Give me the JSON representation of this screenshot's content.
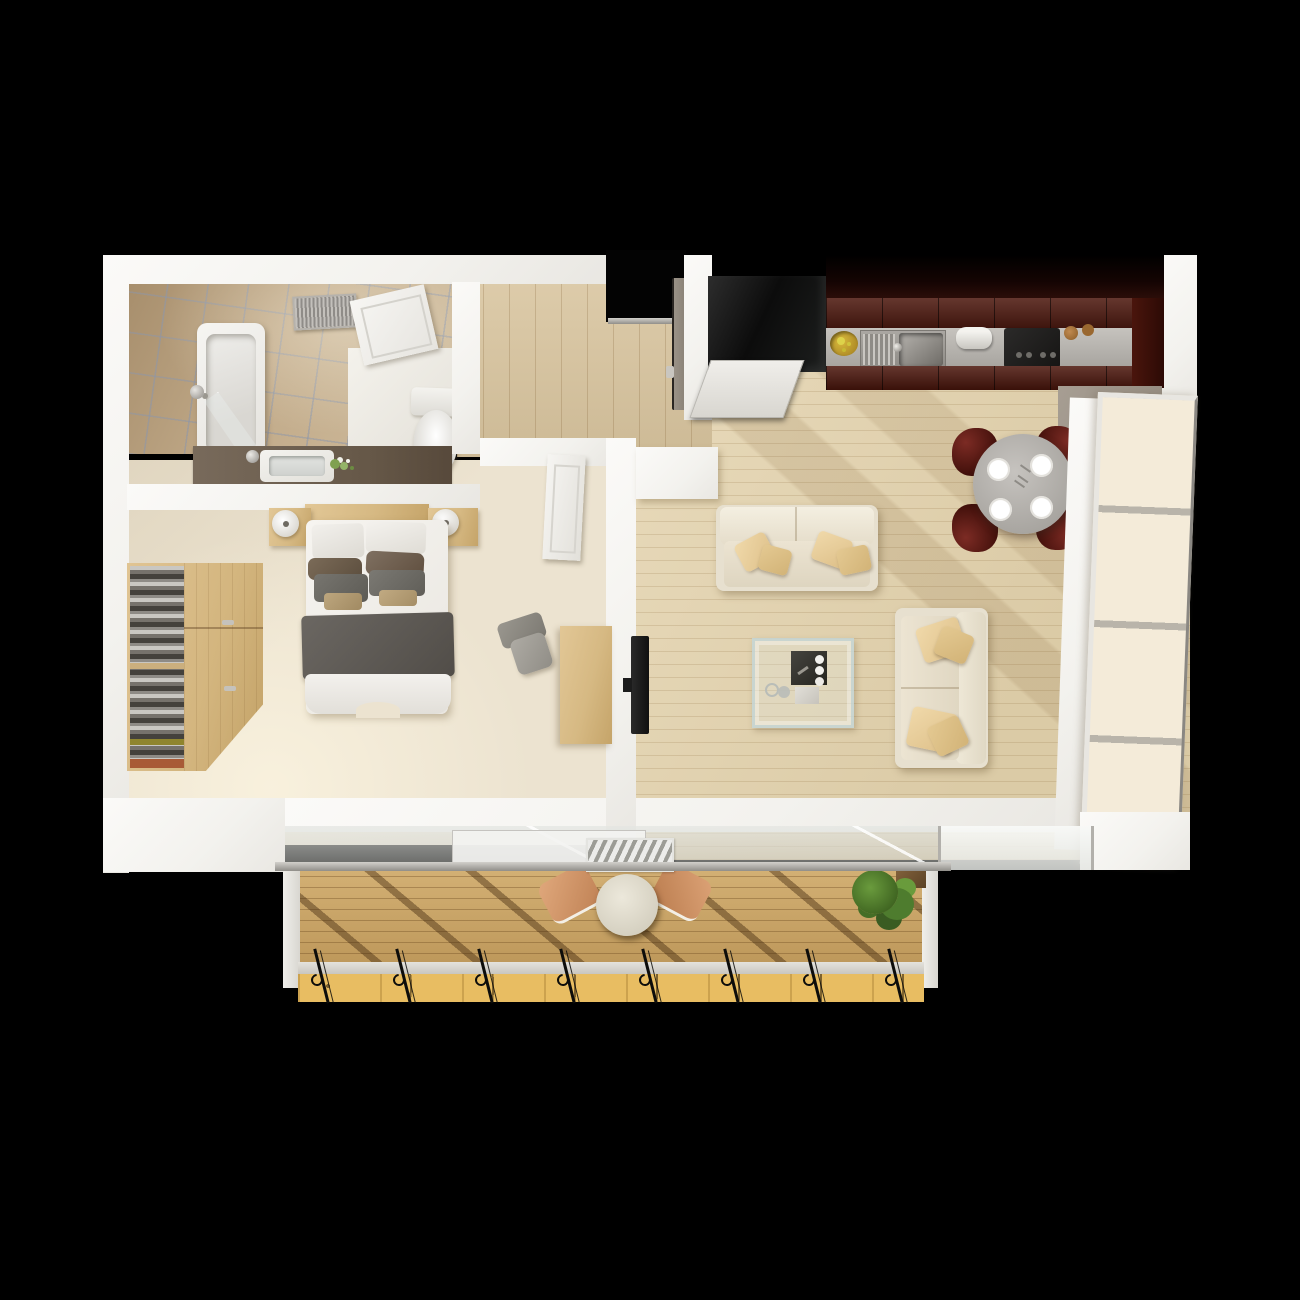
{
  "scene": {
    "type": "3d-floor-plan-top-view",
    "description": "photorealistic top-down render of a one-bedroom apartment with balcony on black background",
    "background_color": "#000000",
    "rooms": [
      {
        "id": "bathroom",
        "label": "Bathroom",
        "floor": "beige marble tile",
        "furniture": [
          "bathtub",
          "shower-fixture",
          "glass-screen",
          "ceiling-vent",
          "vanity-counter",
          "sink",
          "flowers",
          "toilet",
          "door"
        ]
      },
      {
        "id": "hallway",
        "label": "Entry Hallway",
        "floor": "light oak planks",
        "furniture": [
          "entry-door",
          "threshold"
        ]
      },
      {
        "id": "bedroom",
        "label": "Bedroom",
        "floor": "cream carpet",
        "furniture": [
          "double-bed",
          "headboard-shelf",
          "nightstand-left",
          "nightstand-right",
          "lamp-left",
          "lamp-right",
          "wardrobe-shelves",
          "wardrobe-doors",
          "desk",
          "office-chair",
          "bedroom-door"
        ]
      },
      {
        "id": "living-room",
        "label": "Living Room",
        "floor": "light oak planks",
        "furniture": [
          "sofa-top",
          "sofa-right",
          "glass-coffee-table",
          "serving-tray",
          "wall-tv"
        ]
      },
      {
        "id": "kitchen",
        "label": "Kitchen",
        "floor": "light oak planks",
        "furniture": [
          "refrigerator",
          "open-fridge-door",
          "upper-cabinets",
          "counter",
          "sink",
          "drainboard",
          "fruit-bowl",
          "paper-towel-roll",
          "cooktop",
          "spice-mills",
          "tall-cabinet"
        ]
      },
      {
        "id": "dining-area",
        "label": "Dining Area",
        "furniture": [
          "round-table",
          "plates",
          "chair-nw",
          "chair-ne",
          "chair-sw",
          "chair-se"
        ]
      },
      {
        "id": "balcony",
        "label": "Balcony",
        "floor": "golden wood decking",
        "furniture": [
          "bistro-table",
          "chair-left",
          "chair-right",
          "potted-plant",
          "ornate-railing",
          "glass-awning",
          "doormat"
        ]
      }
    ],
    "palette": {
      "background": "#000000",
      "walls": "#f5f4f0",
      "tile_floor": "#bfa888",
      "grout": "#8e96a8",
      "oak_floor": "#e4d3ad",
      "carpet": "#ece3d0",
      "kitchen_cabinet": "#4c160c",
      "counter_steel": "#b2afaa",
      "dining_chair": "#5a1a16",
      "sofa_cream": "#eae3d3",
      "pillow_tan": "#e8cf9e",
      "blanket_gray": "#5f5b56",
      "pillow_brown": "#6f604f",
      "furniture_wood": "#d6b983",
      "deck_wood": "#c59d5c",
      "deck_sunlit": "#e8bd62",
      "railing_iron": "#0d0d0b",
      "plant_green": "#4e7c2e",
      "window_panel": "#f4ebd9",
      "balcony_chair": "#d69a6e"
    },
    "counts": {
      "dining_chairs": 4,
      "plates": 4,
      "sofas": 2,
      "balusters": 8,
      "window_panels": 4
    }
  }
}
